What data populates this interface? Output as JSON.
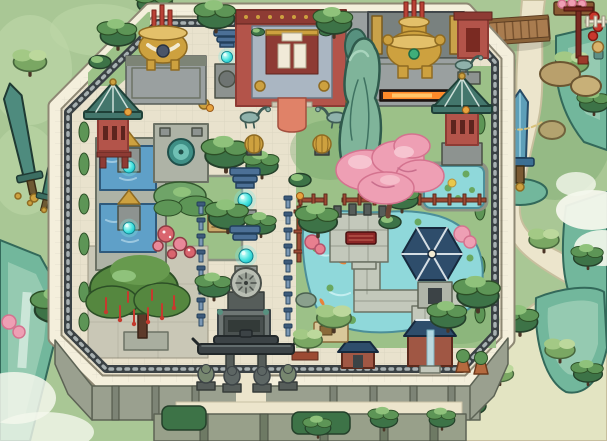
{
  "scene": {
    "type": "game-world-map",
    "style": "hand-painted ink-and-wash wuxia",
    "view": "top-down",
    "setting": "walled sect compound with shrine halls, incense censers, spirit lanterns, ponds and gardens",
    "glowing_orb_count": 5,
    "incense_censers": 2,
    "guardian_lions": 4
  },
  "palette": {
    "bg-green": "#a9c795",
    "meadow": "#bcd6a6",
    "cliff-teal": "#72b79c",
    "cliff-dark": "#33695a",
    "path-cream": "#ece5cc",
    "floor-cream": "#e9e2cd",
    "grass": "#9cc188",
    "grass-dark": "#6fa468",
    "plaza": "#c9c7b6",
    "wall-white": "#f4efdc",
    "wall-band": "#3a4144",
    "stone-base": "#9aa08f",
    "red-wall": "#b3544a",
    "red-dark": "#8e3b34",
    "roof-teal": "#43766c",
    "roof-navy": "#2e4d6b",
    "gold": "#cda13f",
    "gold-dark": "#8f6b22",
    "carpet": "#e08268",
    "orb-cyan": "#2fd6d8",
    "pink": "#ee9fb4",
    "pink-dark": "#d4738f",
    "water-blue": "#5fa0c8",
    "pond-cyan": "#8fd8da",
    "fence-red": "#9c4a33",
    "pine-dark": "#3d7347",
    "pine-mid": "#5d9556",
    "pine-light": "#8fc27b",
    "lantern-blue": "#4c7096",
    "bridge-brown": "#a97c4f",
    "ribbon-red": "#c53a2e",
    "glow-orange": "#ff8a2a"
  },
  "landmarks": [
    {
      "id": "outer-rampart"
    },
    {
      "id": "south-stone-base"
    },
    {
      "id": "main-gate"
    },
    {
      "id": "guardian-lions"
    },
    {
      "id": "ancestral-hall"
    },
    {
      "id": "carpet-approach"
    },
    {
      "id": "crane-statues"
    },
    {
      "id": "incense-censer-west"
    },
    {
      "id": "incense-censer-east"
    },
    {
      "id": "ember-trough"
    },
    {
      "id": "spirit-lantern-orbs"
    },
    {
      "id": "axis-lantern-shrines"
    },
    {
      "id": "stone-clock-disc"
    },
    {
      "id": "stone-altar"
    },
    {
      "id": "twin-spirit-pools"
    },
    {
      "id": "fountain-court"
    },
    {
      "id": "rockery-court"
    },
    {
      "id": "herb-mushrooms"
    },
    {
      "id": "wishing-tree"
    },
    {
      "id": "blossom-tree"
    },
    {
      "id": "taihu-rockery"
    },
    {
      "id": "lily-pond"
    },
    {
      "id": "koi-pond"
    },
    {
      "id": "zigzag-walkway"
    },
    {
      "id": "qin-platform"
    },
    {
      "id": "hex-pavilion"
    },
    {
      "id": "garden-shrines"
    },
    {
      "id": "potted-plants"
    },
    {
      "id": "red-garden-fence"
    },
    {
      "id": "west-pagoda"
    },
    {
      "id": "east-pagoda"
    },
    {
      "id": "ivy-walls"
    },
    {
      "id": "giant-swords-west"
    },
    {
      "id": "jade-sword-monument"
    },
    {
      "id": "wooden-bridge"
    },
    {
      "id": "roadside-stall"
    },
    {
      "id": "red-lanterns"
    },
    {
      "id": "mountain-cliffs"
    },
    {
      "id": "mist"
    },
    {
      "id": "gorge-path"
    },
    {
      "id": "pine-trees"
    }
  ]
}
